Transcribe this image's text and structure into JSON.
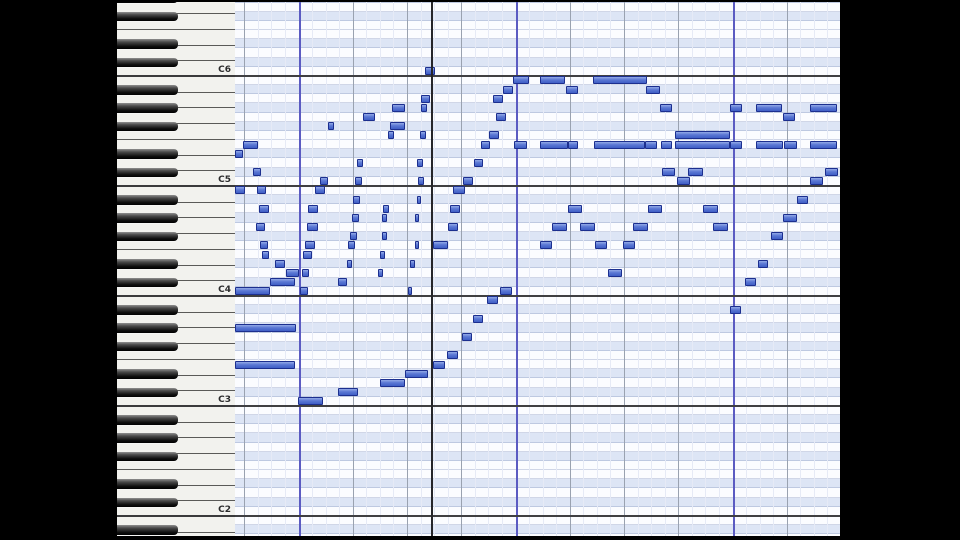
{
  "app": {
    "view": "piano-roll-editor"
  },
  "layout": {
    "width": 960,
    "height": 540,
    "left_bar_w": 117,
    "keyboard_x": 117,
    "keyboard_w": 118,
    "grid_x": 235,
    "grid_w": 605,
    "right_bar_x": 840,
    "right_bar_w": 120,
    "top_edge_h": 2,
    "bottom_edge_h": 4,
    "row_h": 9.1667,
    "c2_line_y": 516,
    "octave_px": 110,
    "white_keys_per_octave": 7,
    "black_key_w": 61,
    "note_h": 8
  },
  "colors": {
    "note_border": "#1c2f8f",
    "note_fill": "#5b78d4",
    "row_blue": "#dde5f5",
    "row_white": "#fbfcff",
    "measure_line": "#5b5bc2",
    "beat_line": "#9aa2b0",
    "sub_line": "#e6eaf6",
    "c_line": "#3f3f42",
    "cursor": "#26262a"
  },
  "octave_labels": [
    {
      "text": "C6",
      "line_y": 76
    },
    {
      "text": "C5",
      "line_y": 186
    },
    {
      "text": "C4",
      "line_y": 296
    },
    {
      "text": "C3",
      "line_y": 406
    },
    {
      "text": "C2",
      "line_y": 516
    }
  ],
  "grid_lines": {
    "sub_start_x": 244.25,
    "sub_step": 13.5625,
    "subs_per_beat": 4,
    "beats_per_measure": 4,
    "measure_offset_subs": 4,
    "cursor_x": 431
  },
  "chart_data": {
    "type": "piano-roll",
    "notes": [
      {
        "p": "D#5",
        "x": 234,
        "w": 9
      },
      {
        "p": "B4",
        "x": 234,
        "w": 11
      },
      {
        "p": "E5",
        "x": 243,
        "w": 15
      },
      {
        "p": "C#5",
        "x": 253,
        "w": 8
      },
      {
        "p": "B4",
        "x": 257,
        "w": 9
      },
      {
        "p": "A4",
        "x": 259,
        "w": 10
      },
      {
        "p": "G4",
        "x": 256,
        "w": 9
      },
      {
        "p": "F4",
        "x": 260,
        "w": 8
      },
      {
        "p": "E4",
        "x": 262,
        "w": 7
      },
      {
        "p": "D#4",
        "x": 275,
        "w": 10
      },
      {
        "p": "D4",
        "x": 286,
        "w": 13
      },
      {
        "p": "C#4",
        "x": 270,
        "w": 25
      },
      {
        "p": "C4",
        "x": 234,
        "w": 36
      },
      {
        "p": "G#3",
        "x": 234,
        "w": 62
      },
      {
        "p": "E3",
        "x": 234,
        "w": 61
      },
      {
        "p": "C4",
        "x": 300,
        "w": 8
      },
      {
        "p": "D4",
        "x": 302,
        "w": 7
      },
      {
        "p": "E4",
        "x": 303,
        "w": 9
      },
      {
        "p": "F4",
        "x": 305,
        "w": 10
      },
      {
        "p": "G4",
        "x": 307,
        "w": 11
      },
      {
        "p": "A4",
        "x": 308,
        "w": 10
      },
      {
        "p": "B4",
        "x": 315,
        "w": 10
      },
      {
        "p": "C5",
        "x": 320,
        "w": 8
      },
      {
        "p": "F#5",
        "x": 328,
        "w": 6
      },
      {
        "p": "C#4",
        "x": 338,
        "w": 9
      },
      {
        "p": "D#4",
        "x": 347,
        "w": 5
      },
      {
        "p": "F4",
        "x": 348,
        "w": 7
      },
      {
        "p": "F#4",
        "x": 350,
        "w": 7
      },
      {
        "p": "G#4",
        "x": 352,
        "w": 7
      },
      {
        "p": "A#4",
        "x": 353,
        "w": 7
      },
      {
        "p": "C5",
        "x": 355,
        "w": 7
      },
      {
        "p": "D5",
        "x": 357,
        "w": 6
      },
      {
        "p": "G5",
        "x": 363,
        "w": 12
      },
      {
        "p": "D4",
        "x": 378,
        "w": 5
      },
      {
        "p": "E4",
        "x": 380,
        "w": 5
      },
      {
        "p": "F#4",
        "x": 382,
        "w": 5
      },
      {
        "p": "G#4",
        "x": 382,
        "w": 5
      },
      {
        "p": "A4",
        "x": 383,
        "w": 6
      },
      {
        "p": "F5",
        "x": 388,
        "w": 6
      },
      {
        "p": "F#5",
        "x": 390,
        "w": 15
      },
      {
        "p": "G#5",
        "x": 392,
        "w": 13
      },
      {
        "p": "C4",
        "x": 408,
        "w": 4
      },
      {
        "p": "D#4",
        "x": 410,
        "w": 5
      },
      {
        "p": "F4",
        "x": 415,
        "w": 4
      },
      {
        "p": "G#4",
        "x": 415,
        "w": 4
      },
      {
        "p": "A#4",
        "x": 417,
        "w": 4
      },
      {
        "p": "C5",
        "x": 418,
        "w": 6
      },
      {
        "p": "D5",
        "x": 417,
        "w": 6
      },
      {
        "p": "F5",
        "x": 420,
        "w": 6
      },
      {
        "p": "G#5",
        "x": 421,
        "w": 6
      },
      {
        "p": "A5",
        "x": 421,
        "w": 9
      },
      {
        "p": "C6",
        "x": 425,
        "w": 10
      },
      {
        "p": "C3",
        "x": 298,
        "w": 25
      },
      {
        "p": "C#3",
        "x": 338,
        "w": 20
      },
      {
        "p": "D3",
        "x": 380,
        "w": 25
      },
      {
        "p": "D#3",
        "x": 405,
        "w": 23
      },
      {
        "p": "E3",
        "x": 433,
        "w": 12
      },
      {
        "p": "F3",
        "x": 447,
        "w": 11
      },
      {
        "p": "G3",
        "x": 462,
        "w": 10
      },
      {
        "p": "A3",
        "x": 473,
        "w": 10
      },
      {
        "p": "B3",
        "x": 487,
        "w": 11
      },
      {
        "p": "C4",
        "x": 500,
        "w": 12
      },
      {
        "p": "F4",
        "x": 433,
        "w": 15
      },
      {
        "p": "G4",
        "x": 448,
        "w": 10
      },
      {
        "p": "A4",
        "x": 450,
        "w": 10
      },
      {
        "p": "B4",
        "x": 453,
        "w": 12
      },
      {
        "p": "C5",
        "x": 463,
        "w": 10
      },
      {
        "p": "D5",
        "x": 474,
        "w": 9
      },
      {
        "p": "E5",
        "x": 481,
        "w": 9
      },
      {
        "p": "F5",
        "x": 489,
        "w": 10
      },
      {
        "p": "G5",
        "x": 496,
        "w": 10
      },
      {
        "p": "A5",
        "x": 493,
        "w": 10
      },
      {
        "p": "A#5",
        "x": 503,
        "w": 10
      },
      {
        "p": "B5",
        "x": 513,
        "w": 16
      },
      {
        "p": "B5",
        "x": 540,
        "w": 25
      },
      {
        "p": "A#5",
        "x": 566,
        "w": 12
      },
      {
        "p": "B5",
        "x": 593,
        "w": 54
      },
      {
        "p": "A#5",
        "x": 646,
        "w": 14
      },
      {
        "p": "G#5",
        "x": 660,
        "w": 12
      },
      {
        "p": "E5",
        "x": 514,
        "w": 13
      },
      {
        "p": "E5",
        "x": 540,
        "w": 28
      },
      {
        "p": "E5",
        "x": 568,
        "w": 10
      },
      {
        "p": "E5",
        "x": 594,
        "w": 51
      },
      {
        "p": "E5",
        "x": 645,
        "w": 12
      },
      {
        "p": "E5",
        "x": 661,
        "w": 11
      },
      {
        "p": "F5",
        "x": 675,
        "w": 55
      },
      {
        "p": "E5",
        "x": 675,
        "w": 55
      },
      {
        "p": "G#5",
        "x": 730,
        "w": 12
      },
      {
        "p": "G#5",
        "x": 756,
        "w": 26
      },
      {
        "p": "G5",
        "x": 783,
        "w": 12
      },
      {
        "p": "G#5",
        "x": 810,
        "w": 27
      },
      {
        "p": "E5",
        "x": 730,
        "w": 12
      },
      {
        "p": "E5",
        "x": 756,
        "w": 27
      },
      {
        "p": "E5",
        "x": 784,
        "w": 13
      },
      {
        "p": "E5",
        "x": 810,
        "w": 27
      },
      {
        "p": "F4",
        "x": 540,
        "w": 12
      },
      {
        "p": "G4",
        "x": 552,
        "w": 15
      },
      {
        "p": "A4",
        "x": 568,
        "w": 14
      },
      {
        "p": "G4",
        "x": 580,
        "w": 15
      },
      {
        "p": "F4",
        "x": 595,
        "w": 12
      },
      {
        "p": "D4",
        "x": 608,
        "w": 14
      },
      {
        "p": "F4",
        "x": 623,
        "w": 12
      },
      {
        "p": "G4",
        "x": 633,
        "w": 15
      },
      {
        "p": "A4",
        "x": 648,
        "w": 14
      },
      {
        "p": "C#5",
        "x": 662,
        "w": 13
      },
      {
        "p": "C5",
        "x": 677,
        "w": 13
      },
      {
        "p": "C#5",
        "x": 688,
        "w": 15
      },
      {
        "p": "A4",
        "x": 703,
        "w": 15
      },
      {
        "p": "G4",
        "x": 713,
        "w": 15
      },
      {
        "p": "A#3",
        "x": 730,
        "w": 11
      },
      {
        "p": "C#4",
        "x": 745,
        "w": 11
      },
      {
        "p": "D#4",
        "x": 758,
        "w": 10
      },
      {
        "p": "F#4",
        "x": 771,
        "w": 12
      },
      {
        "p": "G#4",
        "x": 783,
        "w": 14
      },
      {
        "p": "A#4",
        "x": 797,
        "w": 11
      },
      {
        "p": "C5",
        "x": 810,
        "w": 13
      },
      {
        "p": "C#5",
        "x": 825,
        "w": 13
      }
    ]
  }
}
